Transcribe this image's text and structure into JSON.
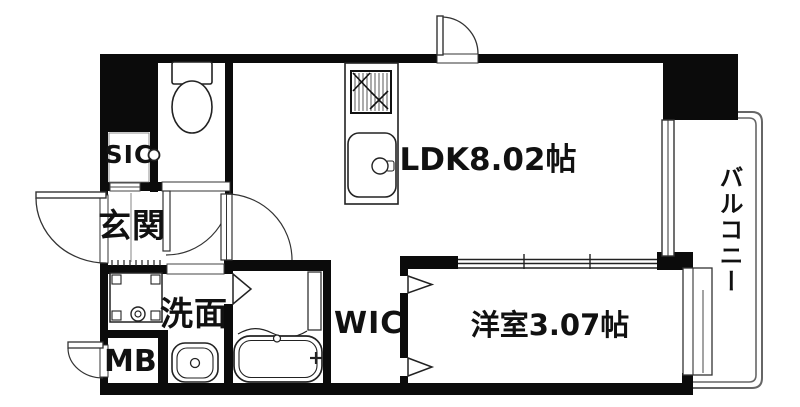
{
  "floorplan": {
    "type": "apartment-floor-plan",
    "labels": {
      "sic": "SIC",
      "entrance": "玄関",
      "ldk": "LDK8.02帖",
      "balcony": "バルコニー",
      "washroom": "洗面",
      "meter_box": "MB",
      "wic": "WIC",
      "bedroom": "洋室3.07帖"
    },
    "areas": {
      "ldk_tatami": "8.02",
      "bedroom_tatami": "3.07"
    },
    "colors": {
      "wall": "#0b0b0b",
      "fixture_line": "#222222",
      "light_line": "#666666",
      "background": "#ffffff"
    }
  }
}
